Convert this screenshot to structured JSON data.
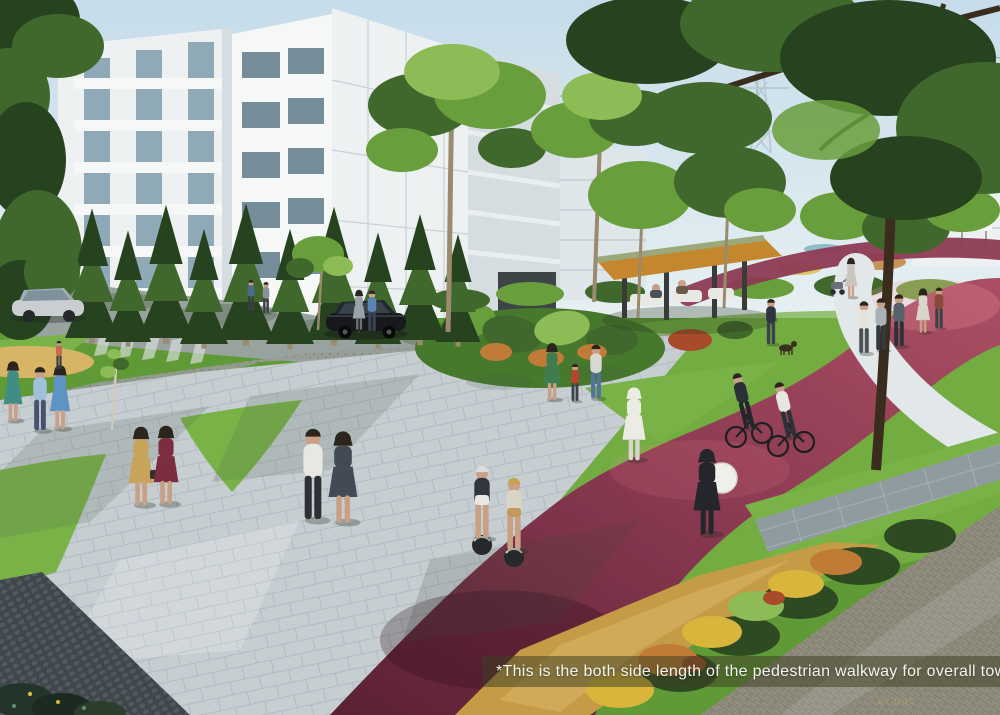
{
  "meta": {
    "type": "architectural-rendering",
    "subject": "Township park with pedestrian walkway, cycle track, gazebo, residential buildings"
  },
  "caption": {
    "text": "*This is the both side length of the pedestrian walkway for overall township."
  },
  "watermark": {
    "text": "BY DMC"
  },
  "palette": {
    "sky-top": "#c6dcea",
    "sky-low": "#eaf2f3",
    "wire": "#8fa0ab",
    "pylon": "#b7c6cf",
    "bldg-face": "#eef1f2",
    "bldg-bright": "#f6f8f8",
    "bldg-side": "#d5dde1",
    "panel-line": "#c3cdd3",
    "glass": "#8fa9b6",
    "glass-dark": "#5f7b88",
    "garage": "#3d4547",
    "trunk": "#9a8a6e",
    "branch": "#3a2d1d",
    "tree-dark": "#27421f",
    "tree-mid": "#41682c",
    "tree-bright": "#699e3c",
    "tree-light": "#8dbb55",
    "lawn": "#5f9a37",
    "lawn-bright": "#79b347",
    "lawn-shade": "#47792c",
    "road": "#98a29e",
    "gravel": "#989c96",
    "gravel-dot": "#6f756f",
    "paver": "#c7ced2",
    "paver-lt": "#e2e7e9",
    "paver-line": "#a9b4ba",
    "cobble-dark": "#3f474b",
    "cobble-dot": "#667077",
    "cobble-tan": "#918e7f",
    "cobble-tan-line": "#6f6c5f",
    "slab": "#8f9b9e",
    "slab-line": "#b0babc",
    "track": "#8d3b53",
    "track-dark": "#5a2033",
    "track-bright": "#aa4f63",
    "gold": "#c49c48",
    "gold-lt": "#d8b466",
    "flower-yellow": "#d9b53b",
    "flower-orange": "#c07c36",
    "flower-red": "#a84b2a",
    "hedge": "#2d4a22",
    "gazebo-wood": "#c5872e",
    "gazebo-roof": "#9aa87a",
    "gazebo-post": "#3a3a38",
    "furniture": "#e9e9e4",
    "skin": "#c9a086",
    "pond": "#7fb4c4",
    "caption-bg": "rgba(62,64,34,0.52)",
    "caption-fg": "#f3f5f0",
    "watermark-fg": "#c7b34b"
  }
}
